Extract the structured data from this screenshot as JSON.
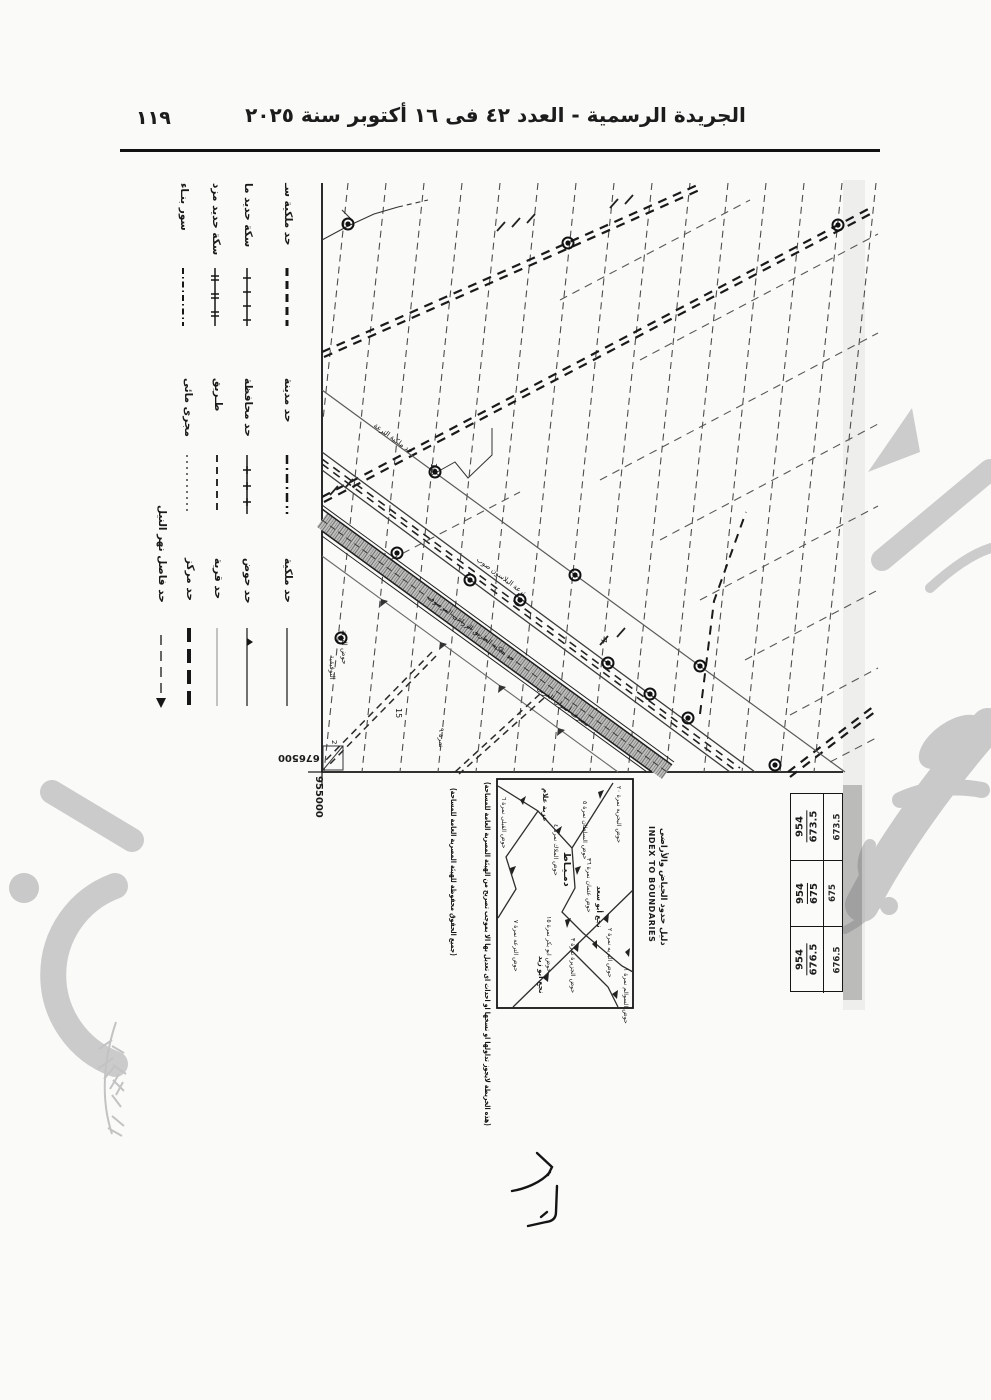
{
  "page": {
    "bg": "#fafaf8",
    "ink": "#1c1c1c",
    "watermark_color": "#c9c9c9"
  },
  "header": {
    "title": "الجريدة الرسمية - العدد ٤٢ فى ١٦ أكتوبر سنة ٢٠٢٥",
    "page_number": "١١٩"
  },
  "legend": {
    "groups": [
      {
        "items": [
          {
            "label": "حد ملكية سـ"
          },
          {
            "label": "سكة حديد ما"
          },
          {
            "label": "سكة حديد مزد"
          },
          {
            "label": "سور بنـاء"
          }
        ]
      },
      {
        "items": [
          {
            "label": "حد مدينة"
          },
          {
            "label": "حد محافظة"
          },
          {
            "label": "طـريق"
          },
          {
            "label": "مجرى مائى"
          }
        ]
      },
      {
        "items": [
          {
            "label": "حد ملكية"
          },
          {
            "label": "حد حوض"
          },
          {
            "label": "حد قرية"
          },
          {
            "label": "حد مركز"
          },
          {
            "label": "حد فاصل نهر النيل"
          }
        ]
      }
    ]
  },
  "map": {
    "easting_label": "955000",
    "northing_label": "676500",
    "labels": {
      "canal": "ترعة البلاسون صوب",
      "canal2": "حد ملكية الترعة",
      "road_strip": "حد ملكية الطريق الزراعى المرصوف",
      "drain": "مصرف أسوان الغربى",
      "hod_a": "حوض البرية",
      "hod_b": "التوفيقية",
      "n10": "10",
      "n15": "15",
      "n9": "نمرة ٩",
      "n7": "7",
      "n2": "2"
    }
  },
  "inset": {
    "title_ar": "دليل حدود الحياض والأراضى",
    "title_en": "INDEX TO BOUNDARIES",
    "bold_labels": [
      "دمـيـاط",
      "عزبة علام",
      "نجع أبو سعد",
      "نجع أبو زيد"
    ],
    "hod_labels": [
      "حوض القبلى نمرة ٦",
      "حوض السلطان نمرة ٥",
      "حوض البحرية نمرة ٢٠",
      "حوض الملاك نمرة ٤",
      "حوض عثمان نمرة ٣٦",
      "حوض ابو بكر نمرة ١٥",
      "حوض الترعة نمرة ٧",
      "حوض الجزيرة نمرة ٣",
      "حوض البريه نمرة ٢",
      "حوض السوالم نمرة ١"
    ]
  },
  "notes": {
    "copyright": "(هذه الخريطة لايجوز تداولها او نسخها او احداث اى تعديل بها الا بموجب تصريح من الهيئة المصرية العامة للمساحة)",
    "rights": "(جميع الحقوق محفوظة للهيئة المصرية العامة للمساحة)"
  },
  "sheet_boxes": [
    {
      "num": "954",
      "den": "673.5",
      "edge": "673.5"
    },
    {
      "num": "954",
      "den": "675",
      "edge": "675"
    },
    {
      "num": "954",
      "den": "676.5",
      "edge": "676.5"
    }
  ]
}
